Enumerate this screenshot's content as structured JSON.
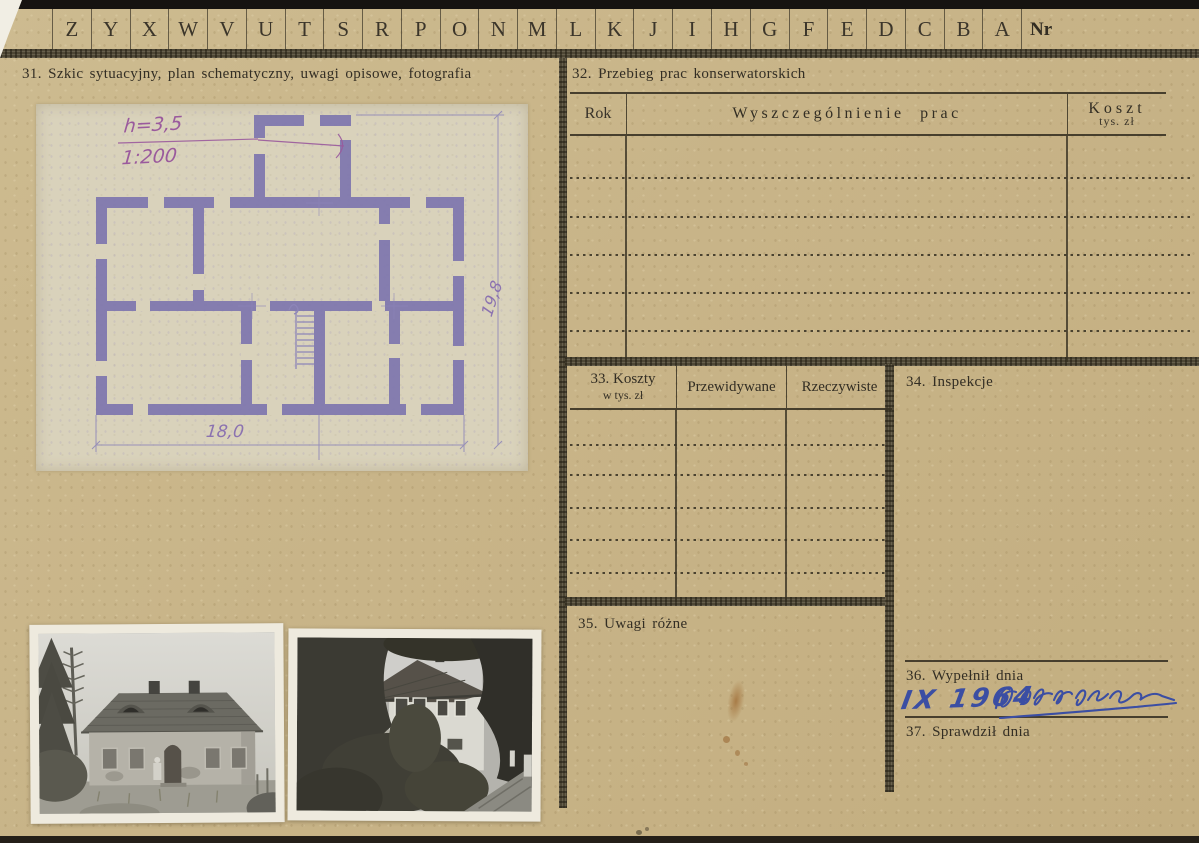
{
  "index_row": {
    "letters": [
      "Z",
      "Y",
      "X",
      "W",
      "V",
      "U",
      "T",
      "S",
      "R",
      "P",
      "O",
      "N",
      "M",
      "L",
      "K",
      "J",
      "I",
      "H",
      "G",
      "F",
      "E",
      "D",
      "C",
      "B",
      "A"
    ],
    "nr": "Nr"
  },
  "sections": {
    "s31": {
      "title": "31. Szkic sytuacyjny, plan schematyczny, uwagi opisowe, fotografia"
    },
    "s32": {
      "title": "32. Przebieg prac konserwatorskich",
      "col_rok": "Rok",
      "col_prace": "Wyszczególnienie prac",
      "col_koszt": "Koszt",
      "col_koszt_sub": "tys. zł"
    },
    "s33": {
      "title_line1": "33. Koszty",
      "title_line2": "w tys. zł",
      "col_przewidywane": "Przewidywane",
      "col_rzeczywiste": "Rzeczywiste"
    },
    "s34": {
      "title": "34. Inspekcje"
    },
    "s35": {
      "title": "35. Uwagi różne"
    },
    "s36": {
      "title": "36. Wypełnił dnia",
      "handwritten_date": "IX 1964"
    },
    "s37": {
      "title": "37. Sprawdził dnia"
    }
  },
  "plan": {
    "height_note": "h=3,5",
    "scale_note": "1:200",
    "width_dim": "18,0",
    "depth_dim": "19,8"
  },
  "colors": {
    "card_bg": "#c8b488",
    "plan_paper": "#d9d2bb",
    "plan_ink": "#7e76ae",
    "print_ink": "#38332a",
    "blue_ink": "#3b4ea3"
  }
}
